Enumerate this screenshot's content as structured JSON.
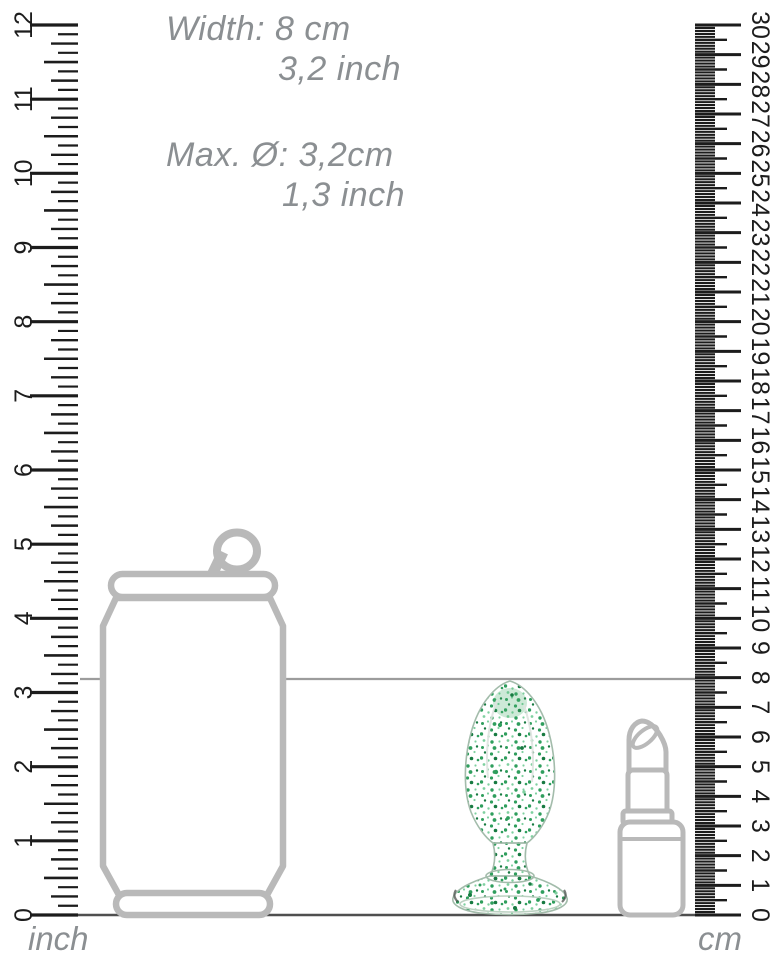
{
  "product": {
    "measurements": {
      "width_metric": "Width: 8 cm",
      "width_imperial": "3,2 inch",
      "diameter_metric": "Max. Ø: 3,2cm",
      "diameter_imperial": "1,3 inch"
    },
    "height_cm": 8,
    "max_diameter_cm": 3.2
  },
  "rulers": {
    "left": {
      "unit": "inch",
      "max": 12,
      "minor_divisions": 8
    },
    "right": {
      "unit": "cm",
      "max": 30,
      "minor_divisions": 10
    }
  },
  "comparison_objects": [
    "soda-can",
    "glitter-glass-plug",
    "lipstick"
  ],
  "colors": {
    "outline": "#b9b9b9",
    "tick": "#1c1c1c",
    "label": "#8b8f92",
    "indicator": "#9c9c9c",
    "baseline": "#4f4f4f",
    "glitter-1": "#2f9e5d",
    "glitter-2": "#7fd0a0",
    "glitter-3": "#177a41",
    "plug-outline": "#a3bcab",
    "plug-tint": "#4caf70"
  }
}
